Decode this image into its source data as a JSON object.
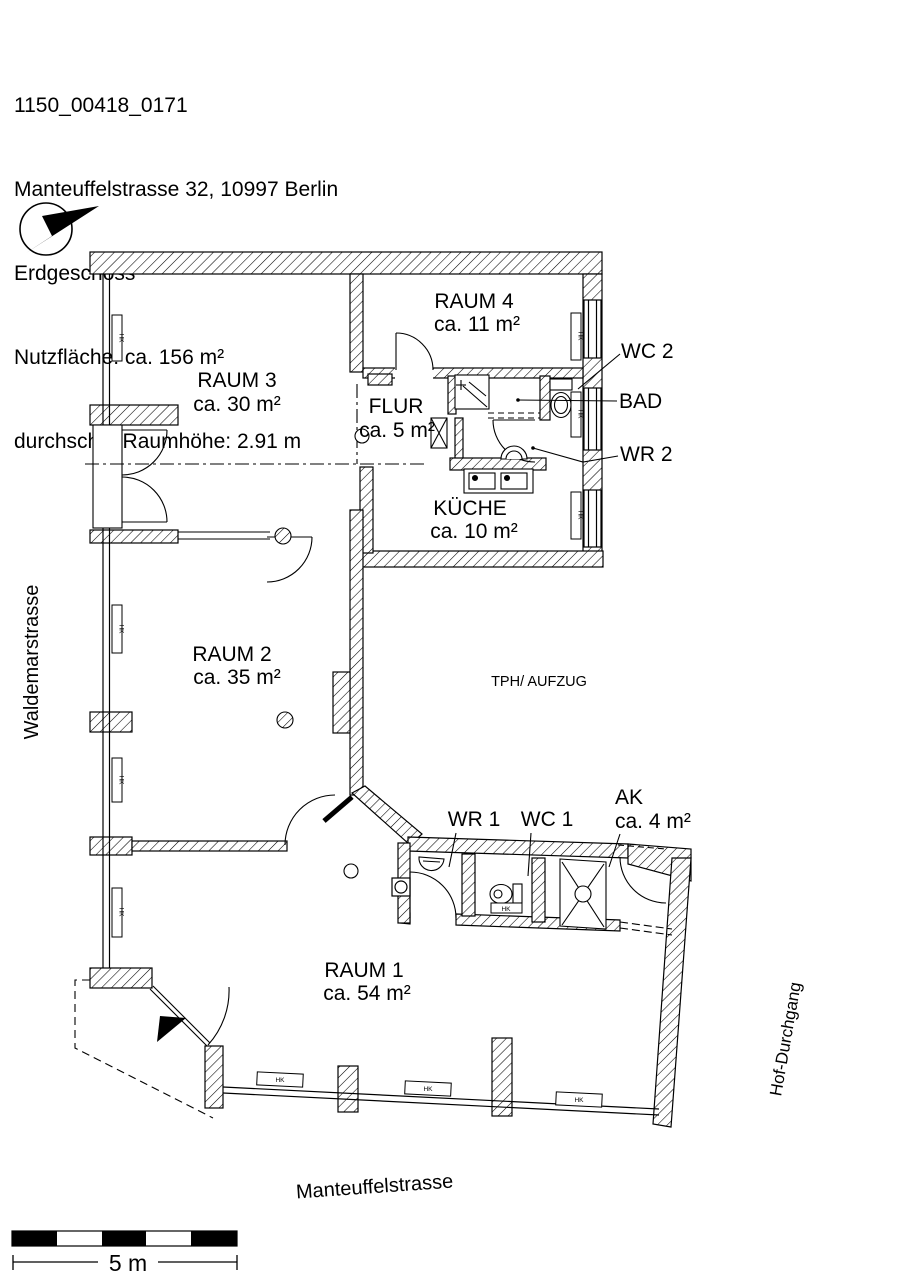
{
  "header": {
    "doc_id": "1150_00418_0171",
    "address": "Manteuffelstrasse 32, 10997 Berlin",
    "floor": "Erdgeschoss",
    "area": "Nutzfläche: ca. 156 m²",
    "ceiling": "durchschn. Raumhöhe: 2.91 m"
  },
  "rooms": {
    "raum1": {
      "name": "RAUM 1",
      "area": "ca. 54 m²"
    },
    "raum2": {
      "name": "RAUM 2",
      "area": "ca. 35 m²"
    },
    "raum3": {
      "name": "RAUM 3",
      "area": "ca. 30 m²"
    },
    "raum4": {
      "name": "RAUM 4",
      "area": "ca. 11 m²"
    },
    "flur": {
      "name": "FLUR",
      "area": "ca. 5 m²"
    },
    "kueche": {
      "name": "KÜCHE",
      "area": "ca. 10 m²"
    },
    "ak": {
      "name": "AK",
      "area": "ca. 4 m²"
    },
    "wc2": "WC 2",
    "bad": "BAD",
    "wr2": "WR 2",
    "wr1": "WR 1",
    "wc1": "WC 1",
    "stairwell": "TPH/ AUFZUG"
  },
  "streets": {
    "left": "Waldemarstrasse",
    "bottom": "Manteuffelstrasse",
    "right": "Hof-Durchgang"
  },
  "scale_bar": {
    "label": "5 m"
  },
  "radiator_label": "HK",
  "colors": {
    "ink": "#000000",
    "paper": "#ffffff"
  }
}
